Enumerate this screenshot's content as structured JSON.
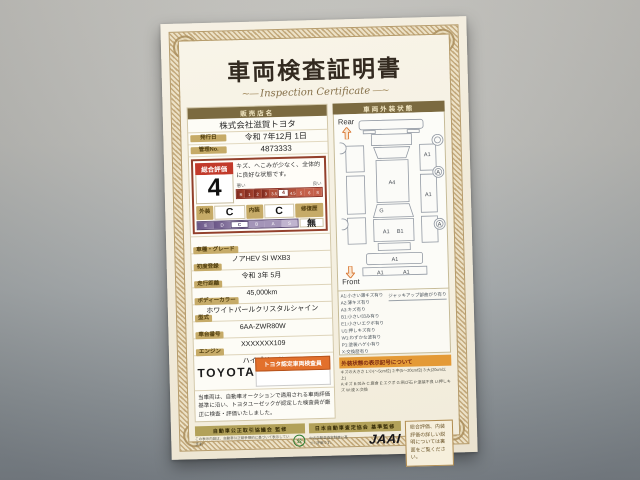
{
  "title": {
    "ja": "車両検査証明書",
    "en": "Inspection Certificate"
  },
  "dealer": {
    "header": "販売店名",
    "name": "株式会社滋賀トヨタ"
  },
  "meta": {
    "issue_label": "発行日",
    "issue_value": "令和 7年12月 1日",
    "manage_label": "管理No.",
    "manage_value": "4873333"
  },
  "evaluation": {
    "label": "総合評価",
    "score": "4",
    "comment": "キズ、へこみが少なく、全体的に良好な状態です。",
    "scale_left": "悪い",
    "scale_right": "良い",
    "scale": [
      "R",
      "1",
      "2",
      "3",
      "3.5",
      "4",
      "4.5",
      "5",
      "6",
      "S"
    ],
    "exterior_label": "外装",
    "exterior_value": "C",
    "interior_label": "内装",
    "interior_value": "C",
    "repair_label": "修復歴",
    "repair_value": "無",
    "grade_scale": [
      "E",
      "D",
      "C",
      "B",
      "A",
      "S"
    ]
  },
  "fields": [
    {
      "label": "車種・グレード",
      "value": "ノアHEV SI WXB3"
    },
    {
      "label": "初度登録",
      "value": "令和 3年 5月"
    },
    {
      "label": "走行距離",
      "value": "45,000km"
    },
    {
      "label": "ボディーカラー",
      "value": "ホワイトパールクリスタルシャイン"
    },
    {
      "label": "型式",
      "value": "6AA-ZWR80W"
    },
    {
      "label": "車台番号",
      "value": "XXXXXXX109"
    },
    {
      "label": "エンジン",
      "value": "ハイブリッド"
    }
  ],
  "certification": {
    "brand": "TOYOTA",
    "badge": "トヨタ認定車両検査員"
  },
  "disclaimer": "当車両は、自動車オークションで適用される車両評価基準に沿い、トヨタユーゼックが認定した検査員が厳正に検査・評価いたしました。",
  "exterior_chart": {
    "header": "車両外装状態",
    "rear_label": "Rear",
    "front_label": "Front",
    "marks": {
      "right_quarter": "A1",
      "roof": "A4",
      "right_door": "A1",
      "windshield": "G",
      "hood_left": "A1",
      "hood_right": "B1",
      "front_bumper": "A1",
      "lower_left": "A1",
      "lower_right": "A1",
      "wheel_mid": "A",
      "wheel_front": "A"
    },
    "legend_lines": [
      "A1:小さい薄キズ有り",
      "A2:薄キズ有り",
      "A3:キズ有り",
      "B1:小さい凹み有り",
      "E1:小さいエクボ有り",
      "U1:押しキズ有り",
      "W1:わずかな波有り",
      "P1:塗装ハゲ小有り",
      "X:交換歴有り"
    ],
    "jack_note": "ジャッキアップ部曲がり有り",
    "symbol_note_title": "外装状態の表示記号について",
    "symbol_note_lines": [
      "キズの大きさ 1:小(〜5cm位) 2:中(5〜20cm位) 3:大(20cm以上)",
      "A:キズ B:凹み C:腐食 E:エクボ G:飛び石 P:塗装不良 U:押しキズ W:波 X:交換"
    ]
  },
  "footer": {
    "council_bar": "自動車公正取引協議会 監修",
    "council_note": "この表示内容は、自動車公正競争規約に基づいて表示しています。",
    "association_bar": "日本自動車査定協会 基準監修",
    "association_note": "中古自動車査定制度に基づく評価です。",
    "jaai": "JAAI",
    "back_note": "総合評価、内装評価の詳しい説明については裏面をご覧ください。"
  }
}
